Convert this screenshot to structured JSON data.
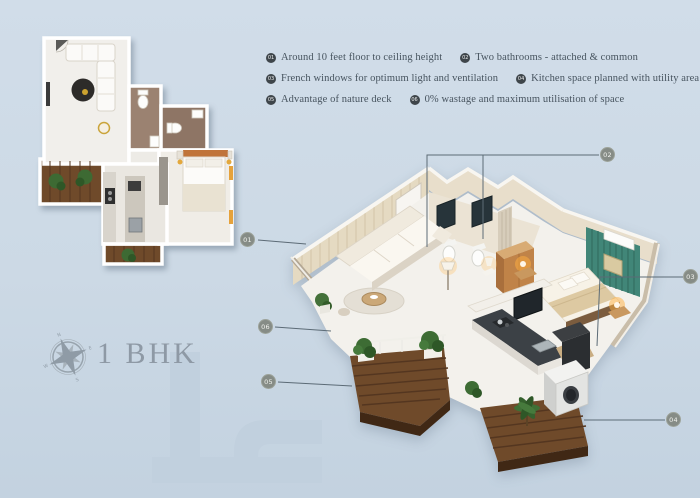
{
  "title": "1 BHK",
  "features": {
    "items": [
      {
        "num": "01",
        "text": "Around 10 feet floor to ceiling height"
      },
      {
        "num": "02",
        "text": "Two bathrooms - attached & common"
      },
      {
        "num": "03",
        "text": "French windows for optimum light and ventilation"
      },
      {
        "num": "04",
        "text": "Kitchen space planned with utility area"
      },
      {
        "num": "05",
        "text": "Advantage of nature deck"
      },
      {
        "num": "06",
        "text": "0% wastage and maximum utilisation of space"
      }
    ]
  },
  "callouts": {
    "labels": [
      "01",
      "02",
      "03",
      "04",
      "05",
      "06"
    ]
  },
  "compass": {
    "directions": [
      "N",
      "E",
      "S",
      "W"
    ]
  },
  "colors": {
    "background": "#ccd9e5",
    "watermark": "#c1d0de",
    "feature_text": "#47545f",
    "badge_bg": "#3e454a",
    "callout_badge_bg": "#82867e",
    "leader_line": "#5c6b76",
    "title_text": "#8e99a5",
    "deck_wood": "#6f4a2a",
    "headboard_teal": "#418678",
    "wardrobe_orange": "#c08348"
  }
}
